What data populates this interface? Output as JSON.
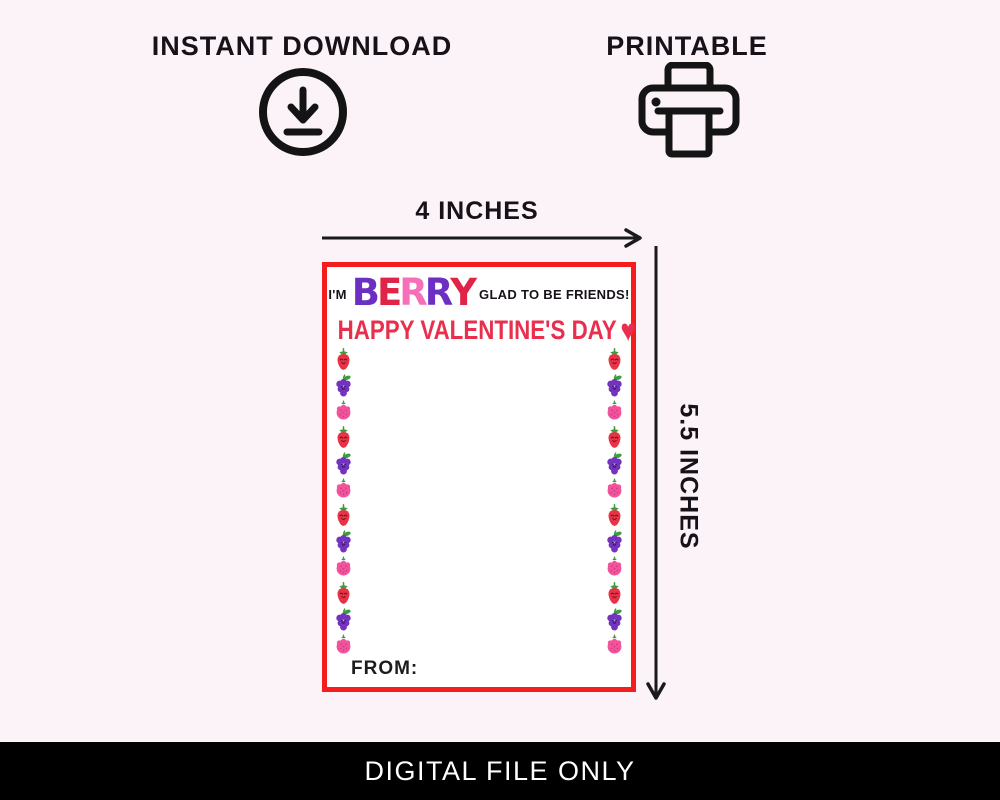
{
  "page": {
    "background_color": "#FBF3F7",
    "badges": [
      {
        "label": "INSTANT DOWNLOAD",
        "icon": "download-circle-icon"
      },
      {
        "label": "PRINTABLE",
        "icon": "printer-icon"
      }
    ],
    "dimension_labels": {
      "width": "4 INCHES",
      "height": "5.5 INCHES"
    },
    "footer": {
      "label": "DIGITAL FILE ONLY",
      "background_color": "#000000",
      "text_color": "#FFFFFF"
    }
  },
  "card": {
    "border_color": "#F31D1D",
    "background_color": "#FFFFFF",
    "greeting": {
      "prefix": "I'M",
      "word_letters": [
        {
          "char": "B",
          "color": "#6B2FC3"
        },
        {
          "char": "E",
          "color": "#E02447"
        },
        {
          "char": "R",
          "color": "#F76FB8"
        },
        {
          "char": "R",
          "color": "#6B2FC3"
        },
        {
          "char": "Y",
          "color": "#E02447"
        }
      ],
      "suffix": "GLAD TO BE FRIENDS!"
    },
    "headline": {
      "text": "HAPPY VALENTINE'S DAY",
      "heart": "♥",
      "color": "#E8304E"
    },
    "from_label": "FROM:",
    "berry_columns": {
      "left": [
        "strawberry",
        "grape",
        "raspberry",
        "strawberry",
        "grape",
        "raspberry",
        "strawberry",
        "grape",
        "raspberry",
        "strawberry",
        "grape",
        "raspberry"
      ],
      "right": [
        "strawberry",
        "grape",
        "raspberry",
        "strawberry",
        "grape",
        "raspberry",
        "strawberry",
        "grape",
        "raspberry",
        "strawberry",
        "grape",
        "raspberry"
      ]
    },
    "berry_colors": {
      "strawberry": "#E83246",
      "grape": "#7233BF",
      "raspberry": "#F2549C",
      "leaf_green": "#3E9C3C"
    }
  }
}
